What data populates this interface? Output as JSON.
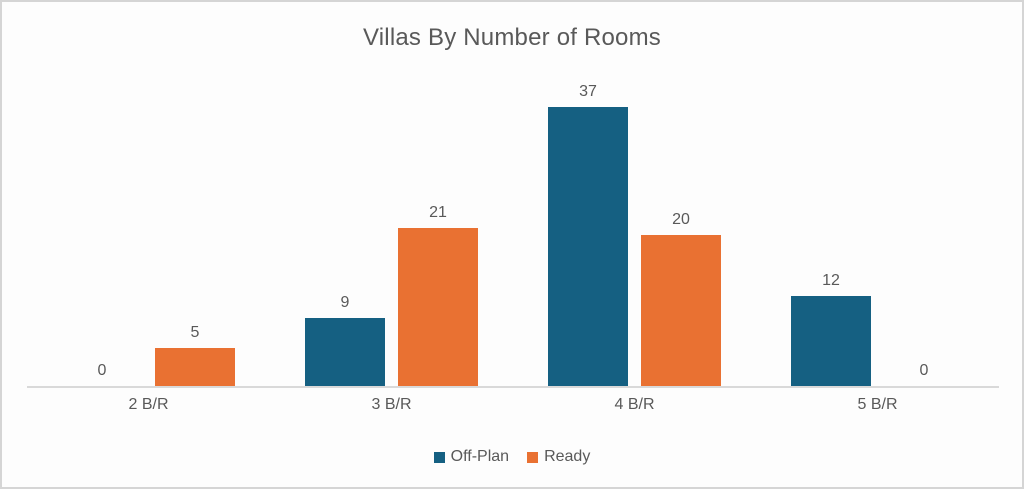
{
  "chart": {
    "background": "#fdfdfd",
    "border_color": "#d5d5d5",
    "text_color": "#595959",
    "axis_line_color": "#d9d9d9"
  },
  "chart_data": {
    "type": "bar",
    "title": "Villas By Number of Rooms",
    "categories": [
      "2 B/R",
      "3 B/R",
      "4 B/R",
      "5 B/R"
    ],
    "series": [
      {
        "name": "Off-Plan",
        "color": "#156082",
        "values": [
          0,
          9,
          37,
          12
        ]
      },
      {
        "name": "Ready",
        "color": "#e97132",
        "values": [
          5,
          21,
          20,
          0
        ]
      }
    ],
    "xlabel": "",
    "ylabel": "",
    "ylim": [
      0,
      40
    ],
    "grid": false,
    "data_labels": true,
    "legend_position": "bottom"
  }
}
